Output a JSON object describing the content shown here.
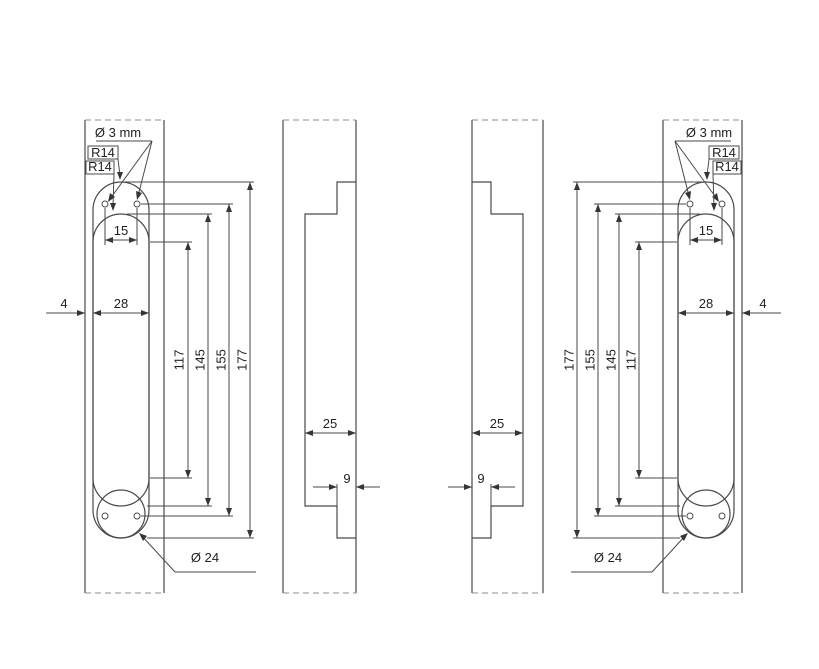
{
  "drawing_title": "hinge-routing-template-dimensioned-drawing",
  "colors": {
    "object_line": "#4a4a4a",
    "break_line": "#8c8c8c",
    "text": "#1f1f1f"
  },
  "views": {
    "front_left": {
      "hole_dia": "Ø 3 mm",
      "outer_radius": "R14",
      "inner_radius": "R14",
      "hole_pitch": "15",
      "slot_width": "28",
      "edge_gap": "4",
      "inner_straight_length": "117",
      "inner_length": "145",
      "hole_row_pitch": "155",
      "outer_length": "177",
      "pocket_dia": "Ø 24"
    },
    "section_left": {
      "recess_depth": "25",
      "step_depth": "9"
    },
    "section_right": {
      "recess_depth": "25",
      "step_depth": "9"
    },
    "front_right": {
      "hole_dia": "Ø 3 mm",
      "outer_radius": "R14",
      "inner_radius": "R14",
      "hole_pitch": "15",
      "slot_width": "28",
      "edge_gap": "4",
      "inner_straight_length": "117",
      "inner_length": "145",
      "hole_row_pitch": "155",
      "outer_length": "177",
      "pocket_dia": "Ø 24"
    }
  }
}
